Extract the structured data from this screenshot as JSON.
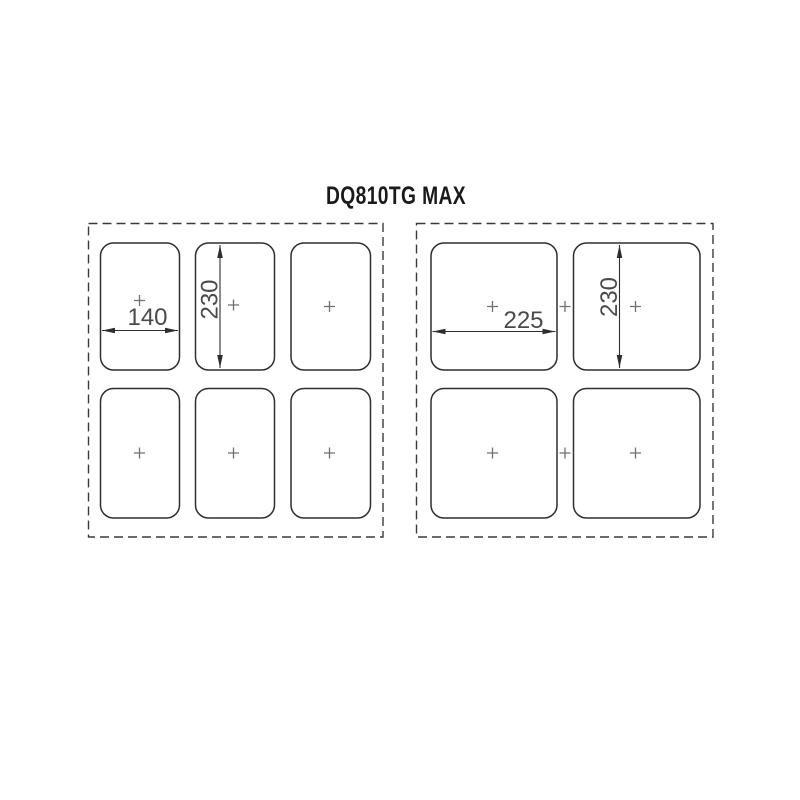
{
  "title": "DQ810TG MAX",
  "panels": {
    "left": {
      "zone_count": 6,
      "rows": 2,
      "columns": 3,
      "dimensions": {
        "zone_width": "140",
        "zone_height": "230"
      }
    },
    "right": {
      "zone_count": 4,
      "rows": 2,
      "columns": 2,
      "dimensions": {
        "zone_width": "225",
        "zone_height": "230"
      }
    }
  },
  "colors": {
    "line": "#2e2e2e",
    "dashed_outline": "#3a3a3a",
    "center_cross": "#6f6f6f",
    "dimension_text": "#4a4a4a",
    "background": "#ffffff"
  }
}
